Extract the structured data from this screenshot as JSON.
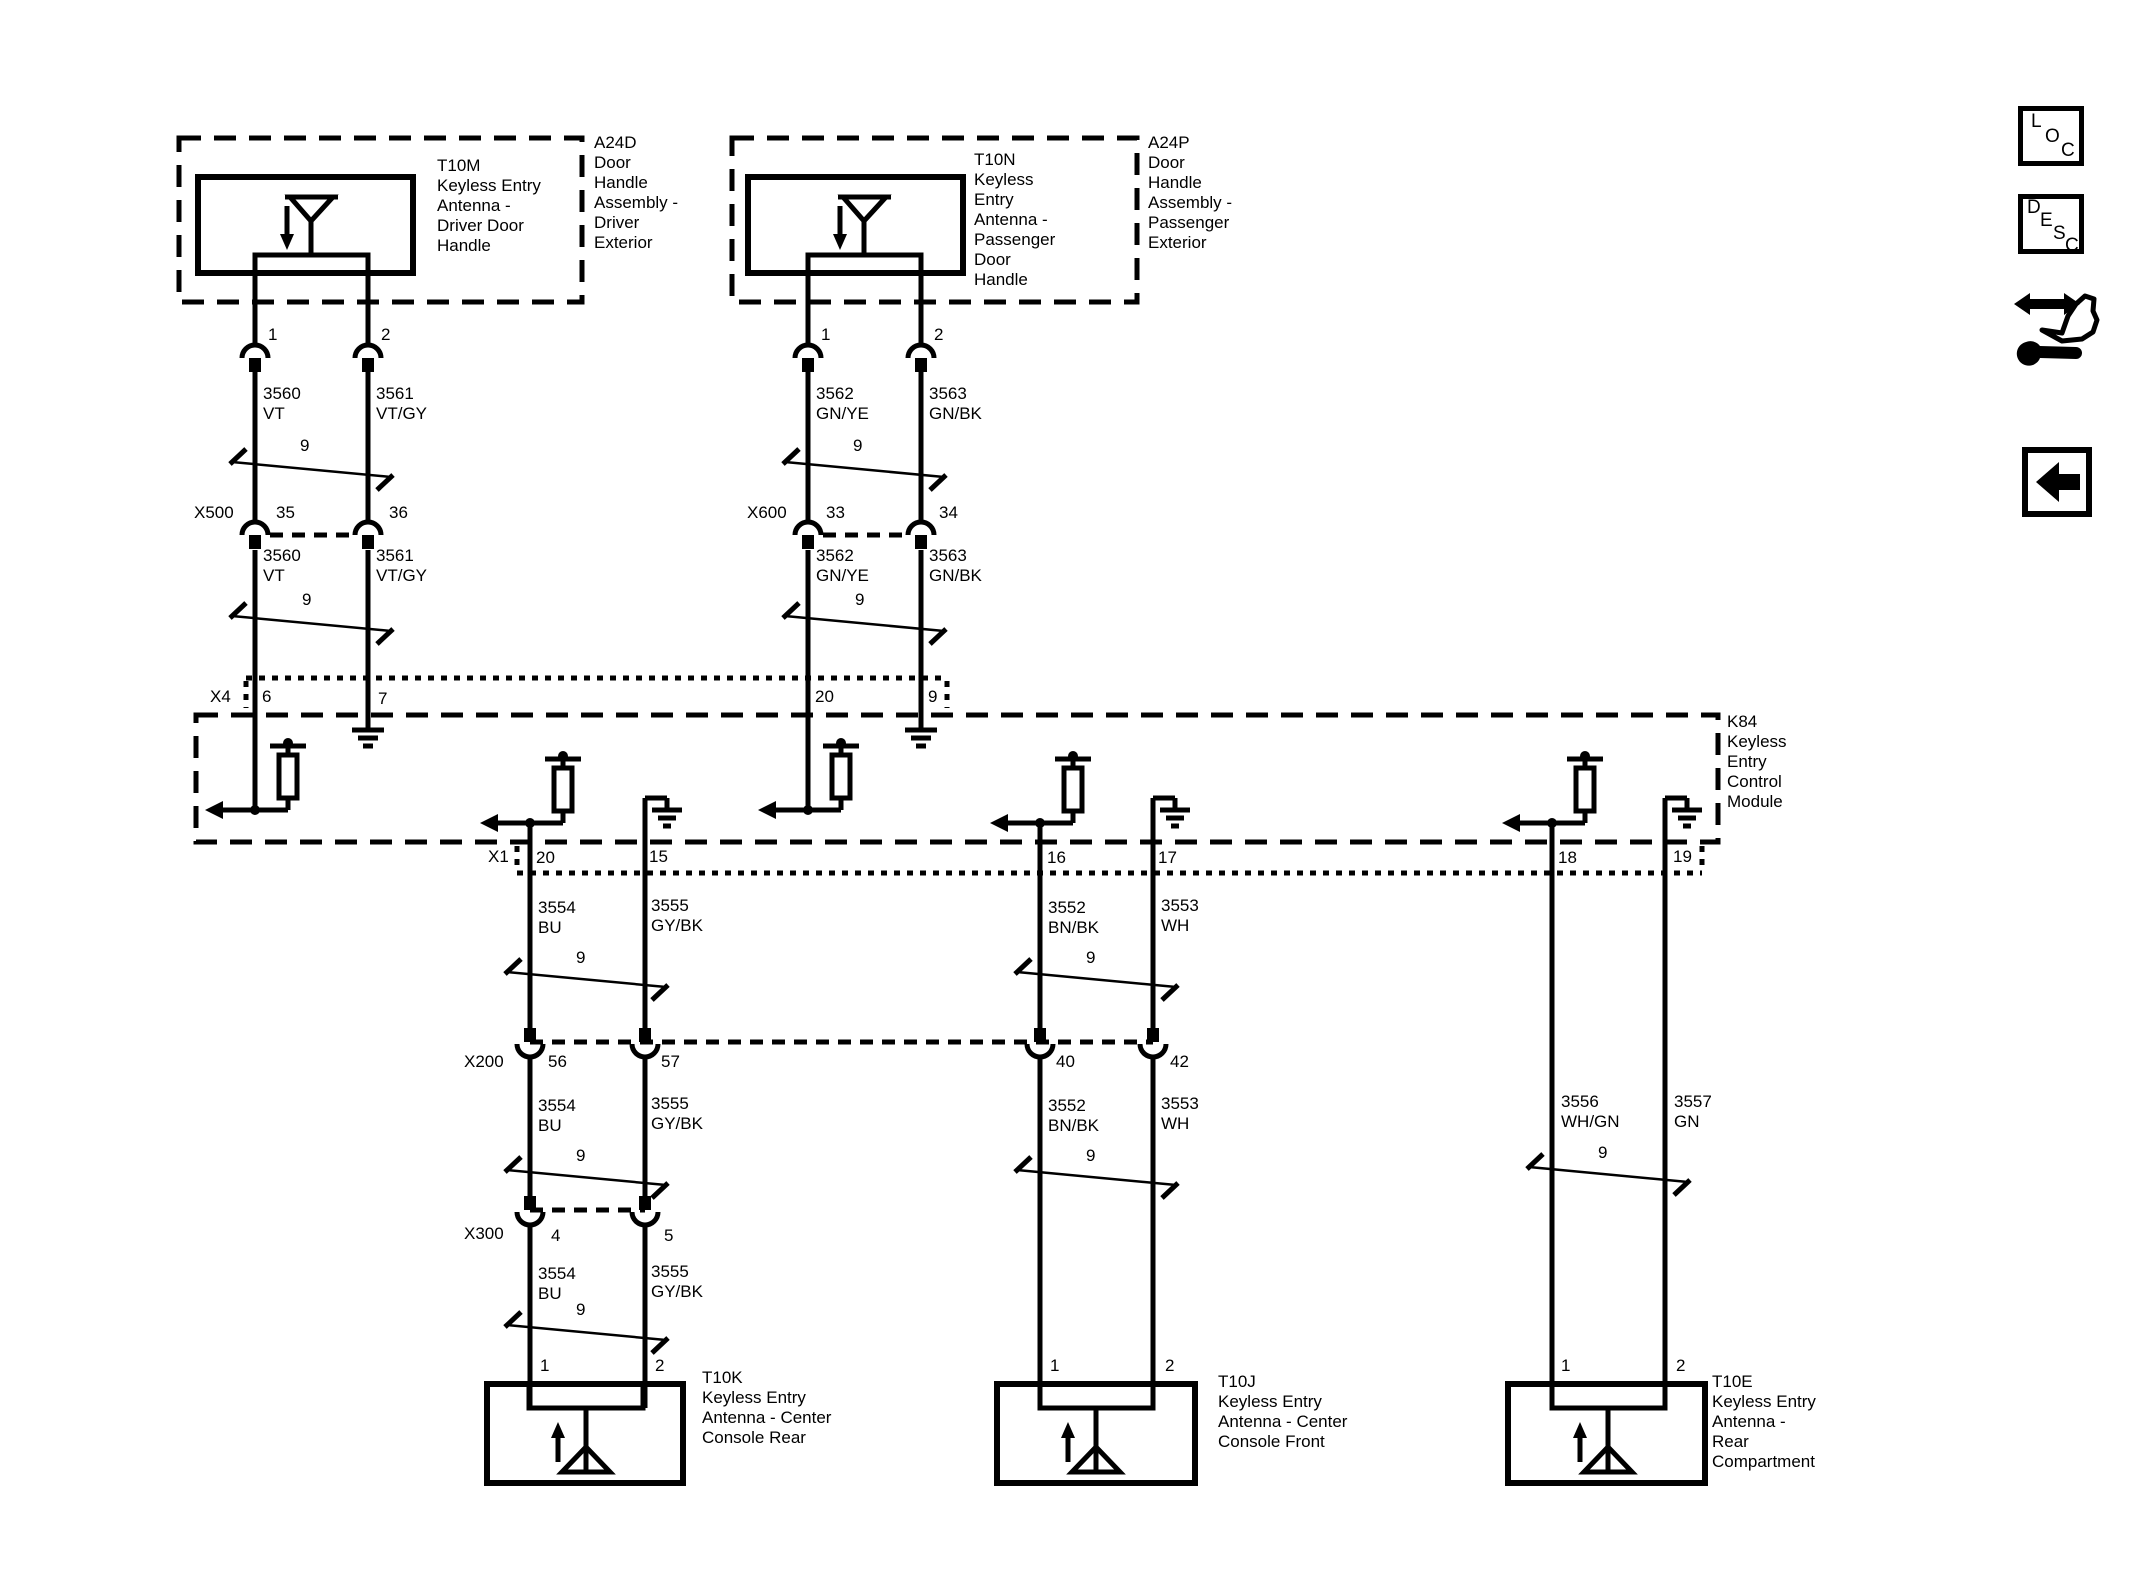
{
  "icons": {
    "loc_letters": [
      "L",
      "O",
      "C"
    ],
    "desc_letters": [
      "D",
      "E",
      "S",
      "C"
    ]
  },
  "module": {
    "id": "K84",
    "name_lines": [
      "Keyless",
      "Entry",
      "Control",
      "Module"
    ],
    "top_connector": "X4",
    "bottom_connector": "X1"
  },
  "top_branches": [
    {
      "assembly_id": "A24D",
      "assembly_lines": [
        "Door",
        "Handle",
        "Assembly -",
        "Driver",
        "Exterior"
      ],
      "antenna_id": "T10M",
      "antenna_lines": [
        "Keyless Entry",
        "Antenna -",
        "Driver Door",
        "Handle"
      ],
      "pin1": "1",
      "pin2": "2",
      "twist": "9",
      "w1_id": "3560",
      "w1_color": "VT",
      "w2_id": "3561",
      "w2_color": "VT/GY",
      "conn_name": "X500",
      "conn_pin1": "35",
      "conn_pin2": "36",
      "mod_pin1": "6",
      "mod_pin2": "7"
    },
    {
      "assembly_id": "A24P",
      "assembly_lines": [
        "Door",
        "Handle",
        "Assembly -",
        "Passenger",
        "Exterior"
      ],
      "antenna_id": "T10N",
      "antenna_lines": [
        "Keyless",
        "Entry",
        "Antenna -",
        "Passenger",
        "Door",
        "Handle"
      ],
      "pin1": "1",
      "pin2": "2",
      "twist": "9",
      "w1_id": "3562",
      "w1_color": "GN/YE",
      "w2_id": "3563",
      "w2_color": "GN/BK",
      "conn_name": "X600",
      "conn_pin1": "33",
      "conn_pin2": "34",
      "mod_pin1": "20",
      "mod_pin2": "9"
    }
  ],
  "bottom_branches": [
    {
      "antenna_id": "T10K",
      "antenna_lines": [
        "Keyless Entry",
        "Antenna - Center",
        "Console Rear"
      ],
      "mod_pin1": "20",
      "mod_pin2": "15",
      "twist": "9",
      "w1_id": "3554",
      "w1_color": "BU",
      "w2_id": "3555",
      "w2_color": "GY/BK",
      "conn1_name": "X200",
      "conn1_pin1": "56",
      "conn1_pin2": "57",
      "conn2_name": "X300",
      "conn2_pin1": "4",
      "conn2_pin2": "5",
      "pin1": "1",
      "pin2": "2"
    },
    {
      "antenna_id": "T10J",
      "antenna_lines": [
        "Keyless Entry",
        "Antenna - Center",
        "Console Front"
      ],
      "mod_pin1": "16",
      "mod_pin2": "17",
      "twist": "9",
      "w1_id": "3552",
      "w1_color": "BN/BK",
      "w2_id": "3553",
      "w2_color": "WH",
      "conn1_pin1": "40",
      "conn1_pin2": "42",
      "pin1": "1",
      "pin2": "2"
    },
    {
      "antenna_id": "T10E",
      "antenna_lines": [
        "Keyless Entry",
        "Antenna -",
        "Rear",
        "Compartment"
      ],
      "mod_pin1": "18",
      "mod_pin2": "19",
      "twist": "9",
      "w1_id": "3556",
      "w1_color": "WH/GN",
      "w2_id": "3557",
      "w2_color": "GN",
      "pin1": "1",
      "pin2": "2"
    }
  ]
}
